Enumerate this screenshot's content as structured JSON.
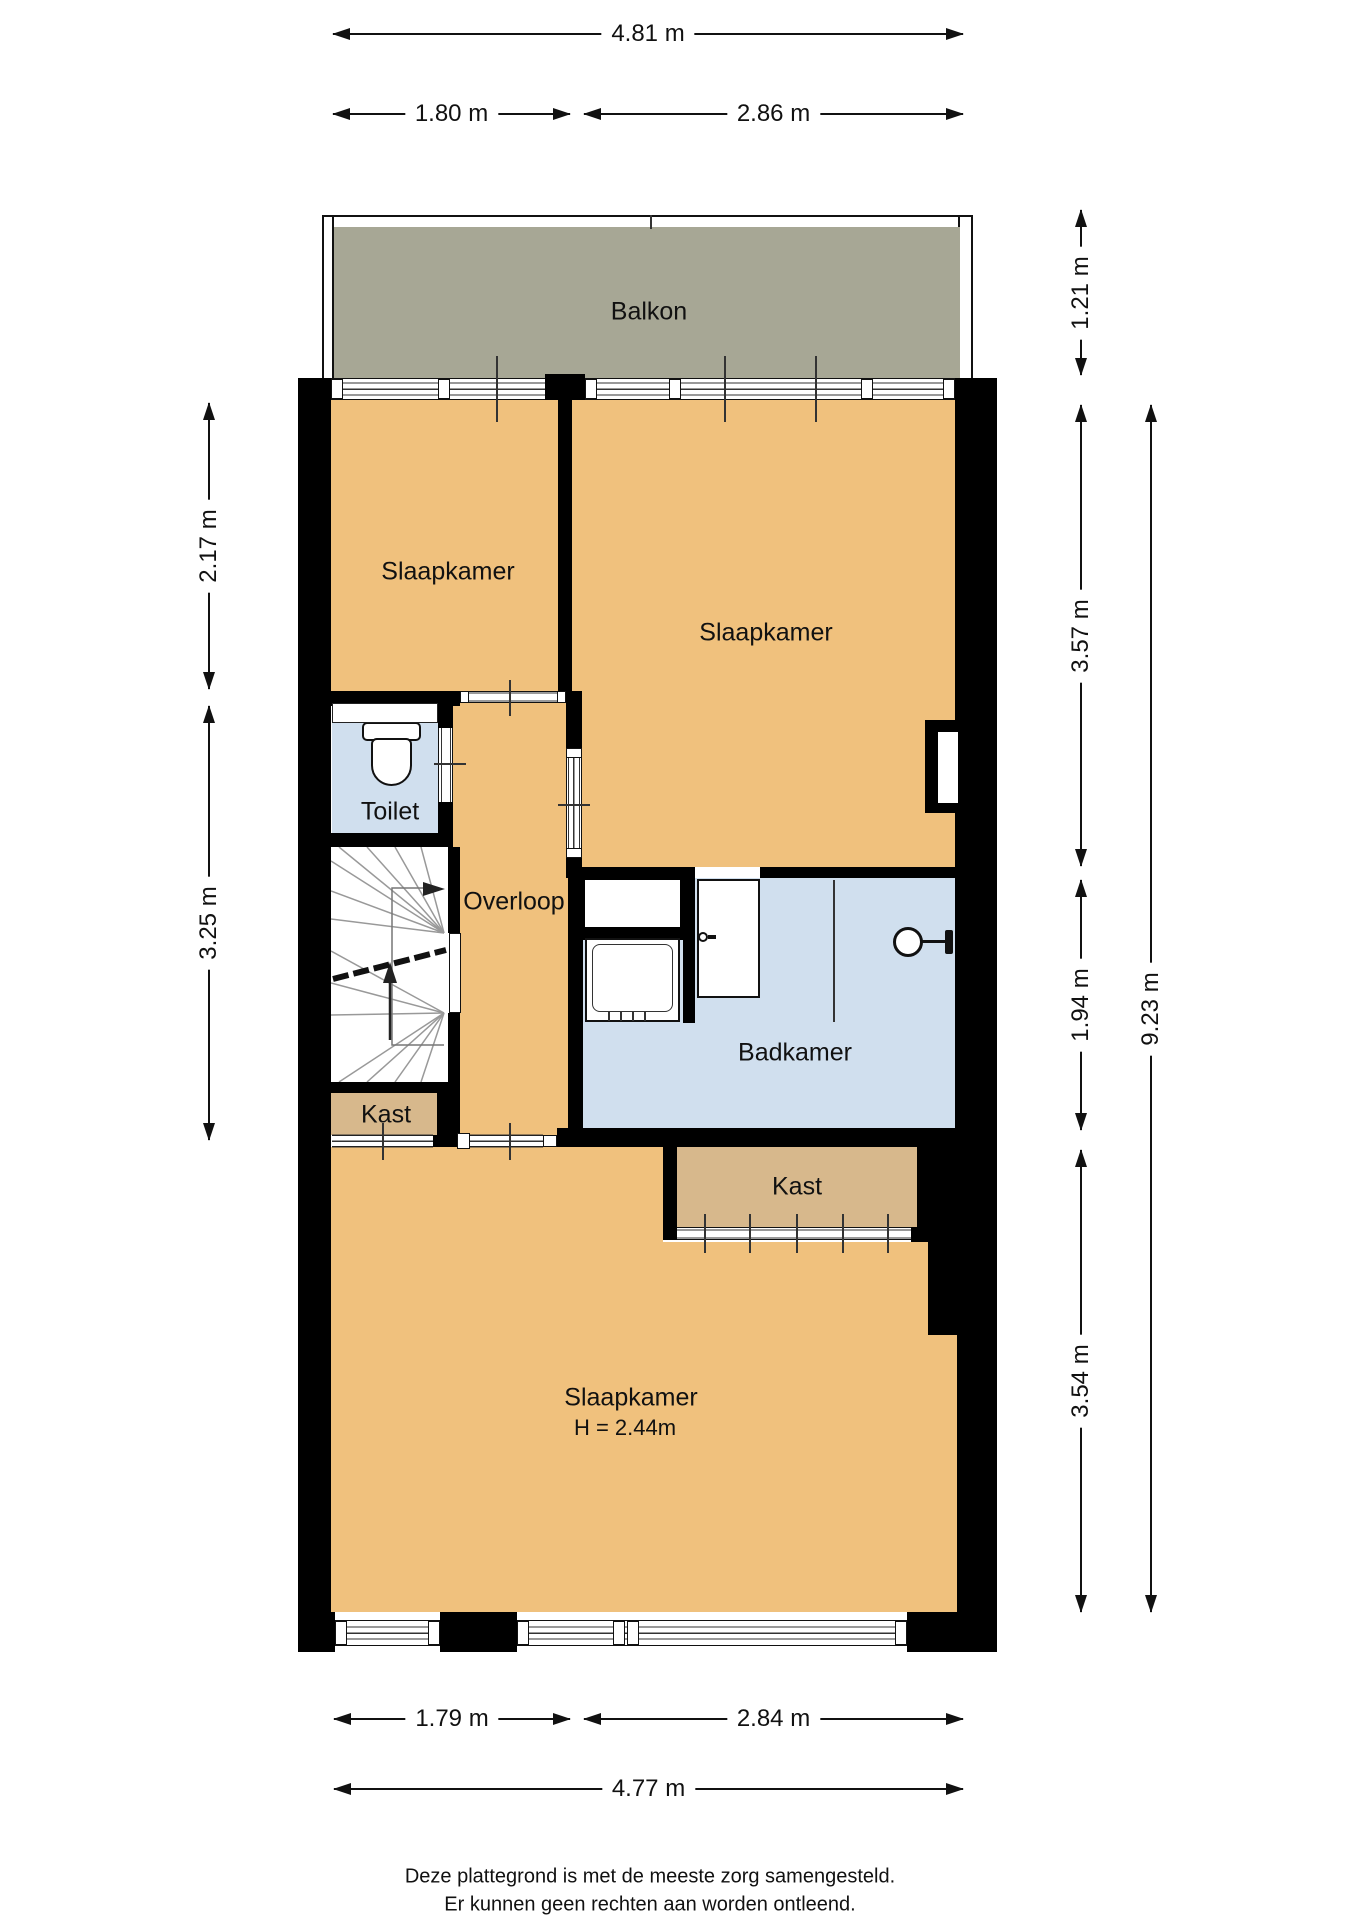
{
  "colors": {
    "wall": "#000000",
    "room_orange": "#f0c17d",
    "room_blue": "#d0dfee",
    "room_tan": "#d7b88c",
    "balcony_gray": "#a7a795"
  },
  "rooms": {
    "balkon": {
      "label": "Balkon"
    },
    "slaapkamer_linksboven": {
      "label": "Slaapkamer"
    },
    "slaapkamer_rechtsboven": {
      "label": "Slaapkamer"
    },
    "toilet": {
      "label": "Toilet"
    },
    "overloop": {
      "label": "Overloop"
    },
    "badkamer": {
      "label": "Badkamer"
    },
    "kast_overloop": {
      "label": "Kast"
    },
    "kast_slaapkamer": {
      "label": "Kast"
    },
    "slaapkamer_beneden": {
      "label": "Slaapkamer",
      "hoogte": "H = 2.44m"
    }
  },
  "dimensions": {
    "top": {
      "totaal": "4.81 m",
      "links": "1.80 m",
      "rechts": "2.86 m"
    },
    "left": {
      "boven": "2.17 m",
      "onder": "3.25 m"
    },
    "right": {
      "balkon": "1.21 m",
      "boven": "3.57 m",
      "midden": "1.94 m",
      "onder": "3.54 m",
      "totaal": "9.23 m"
    },
    "bottom": {
      "links": "1.79 m",
      "rechts": "2.84 m",
      "totaal": "4.77 m"
    }
  },
  "footer": {
    "line1": "Deze plattegrond is met de meeste zorg samengesteld.",
    "line2": "Er kunnen geen rechten aan worden ontleend."
  }
}
